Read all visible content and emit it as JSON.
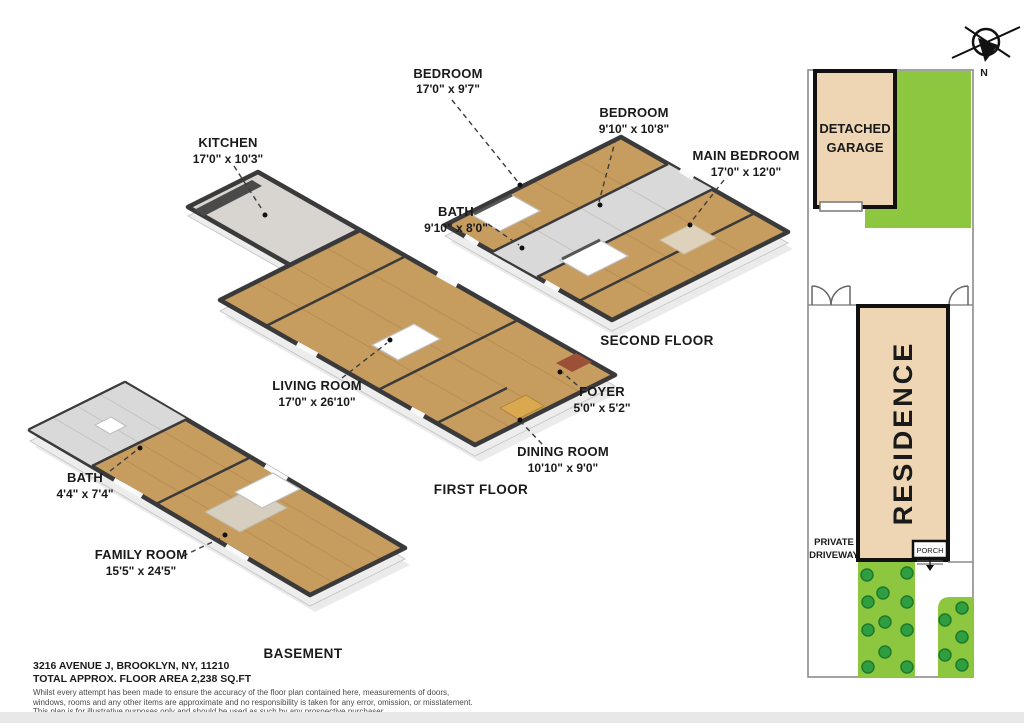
{
  "page": {
    "width": 1024,
    "height": 723,
    "background": "#ffffff"
  },
  "colors": {
    "lawn_green": "#8dc63f",
    "bush_green": "#2f9e41",
    "building_tan": "#eed6b4",
    "wood_floor": "#c79c5f",
    "wall_dark": "#3a3a3a",
    "boundary_gray": "#8c8c8c"
  },
  "floors": {
    "second": {
      "title": "SECOND FLOOR",
      "rooms": [
        {
          "name": "BEDROOM",
          "dims": "17'0\" x 9'7\""
        },
        {
          "name": "BEDROOM",
          "dims": "9'10\" x 10'8\""
        },
        {
          "name": "MAIN BEDROOM",
          "dims": "17'0\" x 12'0\""
        },
        {
          "name": "BATH",
          "dims": "9'10\" x 8'0\""
        }
      ]
    },
    "first": {
      "title": "FIRST FLOOR",
      "rooms": [
        {
          "name": "KITCHEN",
          "dims": "17'0\" x 10'3\""
        },
        {
          "name": "LIVING ROOM",
          "dims": "17'0\" x 26'10\""
        },
        {
          "name": "FOYER",
          "dims": "5'0\" x 5'2\""
        },
        {
          "name": "DINING ROOM",
          "dims": "10'10\" x 9'0\""
        }
      ]
    },
    "basement": {
      "title": "BASEMENT",
      "rooms": [
        {
          "name": "BATH",
          "dims": "4'4\" x 7'4\""
        },
        {
          "name": "FAMILY ROOM",
          "dims": "15'5\" x 24'5\""
        }
      ]
    }
  },
  "site": {
    "north_label": "N",
    "garage_lines": [
      "DETACHED",
      "GARAGE"
    ],
    "residence_label": "RESIDENCE",
    "driveway_lines": [
      "PRIVATE",
      "DRIVEWAY"
    ],
    "porch_label": "PORCH"
  },
  "footer": {
    "address": "3216 AVENUE J, BROOKLYN, NY, 11210",
    "area": "TOTAL APPROX. FLOOR AREA 2,238 SQ.FT",
    "disclaimer": [
      "Whilst every attempt has been made to ensure the accuracy of the floor plan contained here, measurements of doors,",
      "windows, rooms and any other items are approximate and no responsibility is taken for any error, omission, or misstatement.",
      "This plan is for illustrative purposes only and should be used as such by any prospective purchaser."
    ]
  }
}
